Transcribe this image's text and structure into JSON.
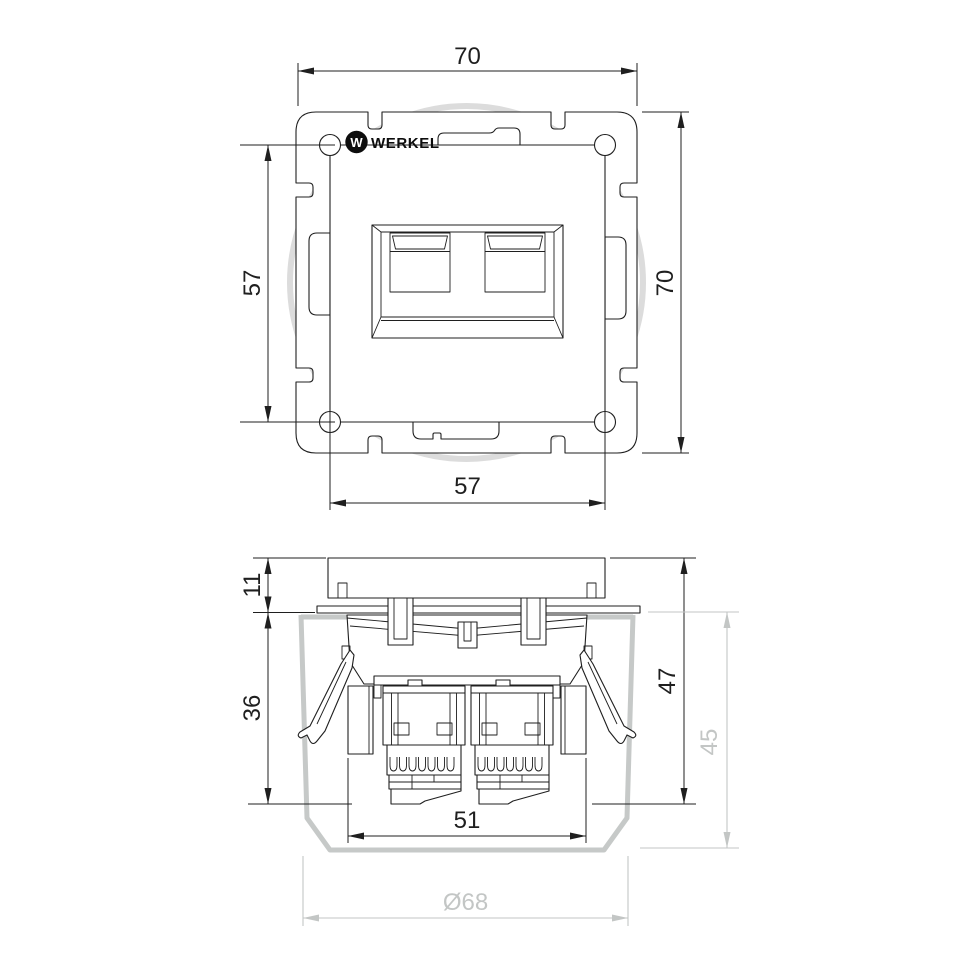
{
  "brand": {
    "name": "WERKEL",
    "mark": "W"
  },
  "colors": {
    "line": "#1f1f1f",
    "box_gray": "#c6c9c8",
    "dim_gray": "#c3c6c5",
    "arc_gray": "#dcdcdc",
    "background": "#ffffff"
  },
  "front_view": {
    "dim_overall_width": "70",
    "dim_overall_height": "70",
    "dim_plate_height": "57",
    "dim_plate_width": "57"
  },
  "side_view": {
    "dim_faceplate_thickness": "11",
    "dim_recess_depth": "36",
    "dim_total_depth": "47",
    "dim_box_depth": "45",
    "dim_mech_width": "51",
    "dim_box_diameter": "Ø68"
  }
}
